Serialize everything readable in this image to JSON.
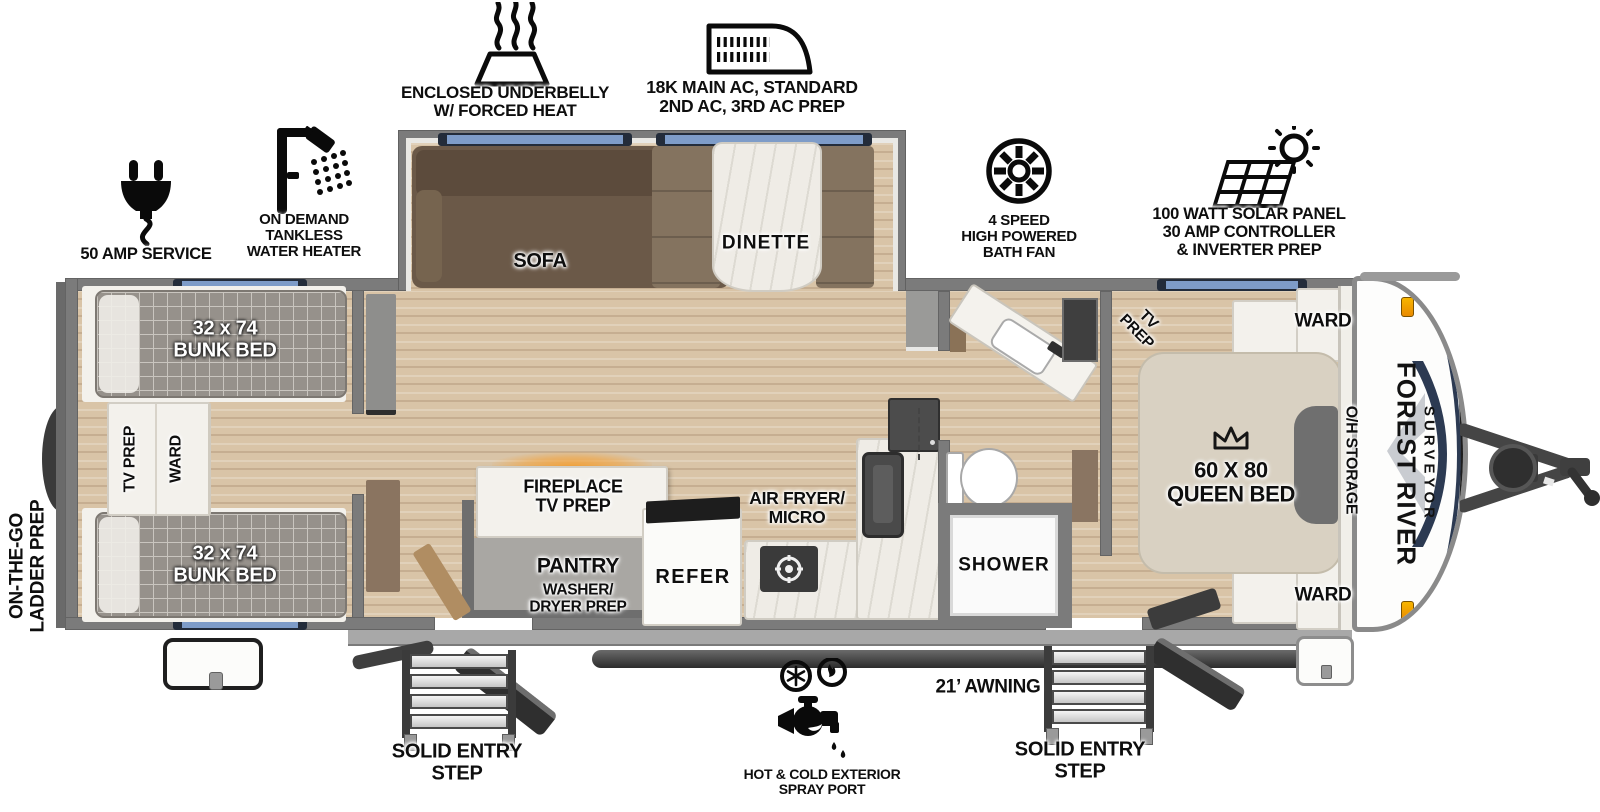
{
  "title": "Forest River Surveyor travel trailer floor plan",
  "colors": {
    "wall": "#7b7b7b",
    "floor_wood": "#d9c4a7",
    "window_blue": "#7e9cc8",
    "fireplace_glow_orange": "#f2a23b",
    "brand_navy": "#2c3a52",
    "mattress_gray": "#96918b",
    "marker_light_orange": "#f0911c"
  },
  "callouts": {
    "underbelly": {
      "icon": "heat-icon",
      "label": "ENCLOSED UNDERBELLY\nW/ FORCED HEAT"
    },
    "ac": {
      "icon": "ac-unit-icon",
      "label": "18K MAIN AC, STANDARD\n2ND AC, 3RD AC PREP"
    },
    "fan": {
      "icon": "fan-icon",
      "label": "4 SPEED\nHIGH POWERED\nBATH FAN"
    },
    "solar": {
      "icon": "solar-panel-icon",
      "label": "100 WATT SOLAR PANEL\n30 AMP CONTROLLER\n& INVERTER PREP"
    },
    "amp": {
      "icon": "power-plug-icon",
      "label": "50 AMP SERVICE"
    },
    "heater": {
      "icon": "shower-head-icon",
      "label": "ON DEMAND\nTANKLESS\nWATER HEATER"
    }
  },
  "exterior": {
    "ladder": "ON-THE-GO\nLADDER PREP",
    "awning": "21’ AWNING",
    "spray": "HOT & COLD EXTERIOR\nSPRAY PORT",
    "step_left": "SOLID ENTRY\nSTEP",
    "step_right": "SOLID ENTRY\nSTEP"
  },
  "rooms": {
    "bunk_top": "32 x 74\nBUNK BED",
    "bunk_bottom": "32 x 74\nBUNK BED",
    "bunk_tv": "TV PREP",
    "bunk_ward": "WARD",
    "sofa": "SOFA",
    "dinette": "DINETTE",
    "fireplace": "FIREPLACE\nTV PREP",
    "pantry_title": "PANTRY",
    "pantry_sub": "WASHER/\nDRYER PREP",
    "refer": "REFER",
    "airfryer": "AIR FRYER/\nMICRO",
    "shower": "SHOWER",
    "bed_tv": "TV PREP",
    "queen": "60 X 80\nQUEEN BED",
    "ward_top": "WARD",
    "ward_bottom": "WARD",
    "oh": "O/H STORAGE"
  },
  "branding": {
    "make": "FOREST RIVER",
    "model": "SURVEYOR"
  }
}
